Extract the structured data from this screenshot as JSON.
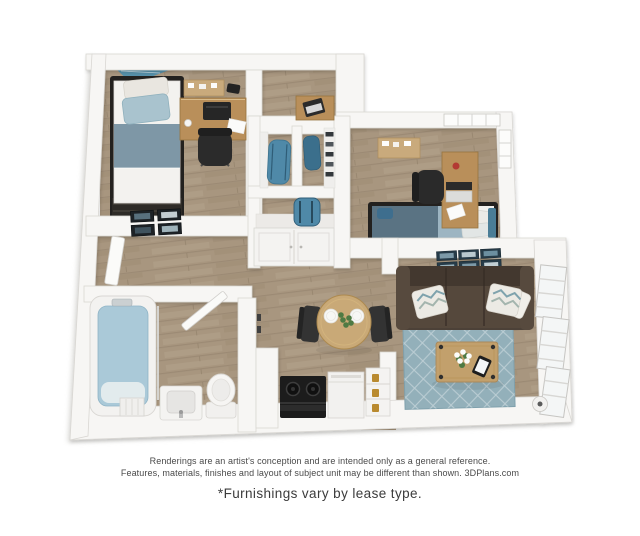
{
  "disclaimer": {
    "line1": "Renderings are an artist's conception and are intended only as a general reference.",
    "line2": "Features, materials, finishes and layout of subject unit may be different than shown. 3DPlans.com",
    "footnote": "*Furnishings vary by lease type."
  },
  "floorplan": {
    "type": "3d-isometric-apartment-rendering",
    "rooms": {
      "bedroom_1": {
        "furnishings": [
          "twin bed with dark metal frame",
          "blue striped bedding",
          "desk with printer",
          "office chair",
          "corkboard",
          "teal accent rug"
        ]
      },
      "bedroom_2": {
        "furnishings": [
          "bed with slate blue bedding",
          "desk with laptop",
          "office chair",
          "corkboard",
          "corner window"
        ]
      },
      "closets": {
        "furnishings": [
          "two shelved closets with blue duffel bags",
          "shelf with blue backpack",
          "double-door cabinet"
        ]
      },
      "hallway": {
        "furnishings": [
          "gallery wall of four framed photos",
          "open door"
        ]
      },
      "bathroom": {
        "furnishings": [
          "bathtub with water",
          "vanity sink",
          "toilet",
          "hamper",
          "open door"
        ]
      },
      "kitchen": {
        "furnishings": [
          "black range cooktop",
          "dishwasher",
          "open shelf with jars",
          "wall hooks"
        ]
      },
      "dining_area": {
        "furnishings": [
          "round wood table",
          "two plates",
          "plant centerpiece",
          "two chairs"
        ]
      },
      "living_room": {
        "furnishings": [
          "brown sofa",
          "chevron pillows",
          "blue diamond rug",
          "wood coffee table",
          "flowers",
          "tablet",
          "gallery wall of six framed prints",
          "windows",
          "floor lamp"
        ]
      }
    },
    "colors": {
      "wall": "#f7f6f4",
      "wall_edge": "#d9d7d3",
      "wood_base": "#a8967f",
      "floor_teal": "#4f8fad",
      "bed1_accent": "#7e97a6",
      "pillow_blue": "#a9c3ce",
      "bed2_blanket": "#5a7383",
      "bed2_band": "#9db5c2",
      "desk_wood": "#b98f5a",
      "sofa": "#4c4138",
      "rug": "#93b0ba",
      "coffee_wood": "#c2a06c",
      "table_wood": "#c9a977",
      "plant": "#4e7a43",
      "frame_dark": "#1d2226",
      "frame_navy": "#273c49",
      "bag_teal": "#4f89a8",
      "water": "#aac9d8",
      "appliance_black": "#1c1c1c",
      "jar_amber": "#b98a2f"
    }
  }
}
